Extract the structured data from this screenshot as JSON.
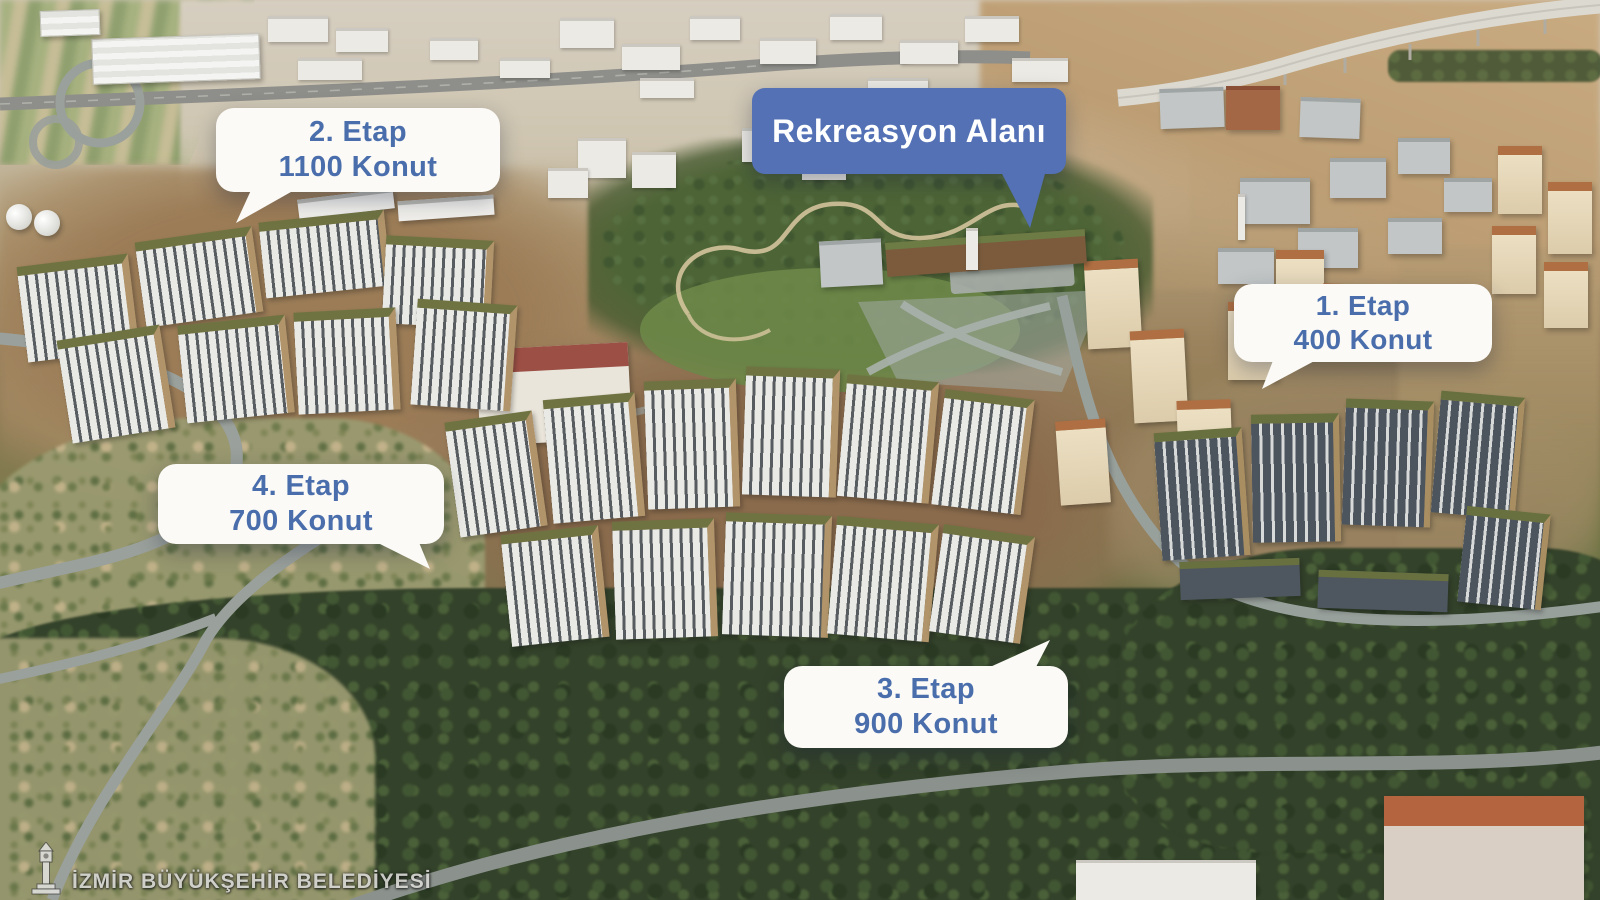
{
  "callouts": {
    "etap2": {
      "line1": "2. Etap",
      "line2": "1100 Konut"
    },
    "rekreasyon": {
      "label": "Rekreasyon Alanı"
    },
    "etap1": {
      "line1": "1. Etap",
      "line2": "400 Konut"
    },
    "etap4": {
      "line1": "4. Etap",
      "line2": "700 Konut"
    },
    "etap3": {
      "line1": "3. Etap",
      "line2": "900 Konut"
    }
  },
  "watermark": {
    "text": "İZMİR BÜYÜKŞEHİR BELEDİYESİ",
    "icon": "izmir-clock-tower-icon"
  },
  "colors": {
    "callout_white_bg": "#fbfaf6",
    "callout_text_blue": "#4a6eac",
    "callout_blue_bg": "#5371b4",
    "callout_text_white": "#ffffff"
  }
}
